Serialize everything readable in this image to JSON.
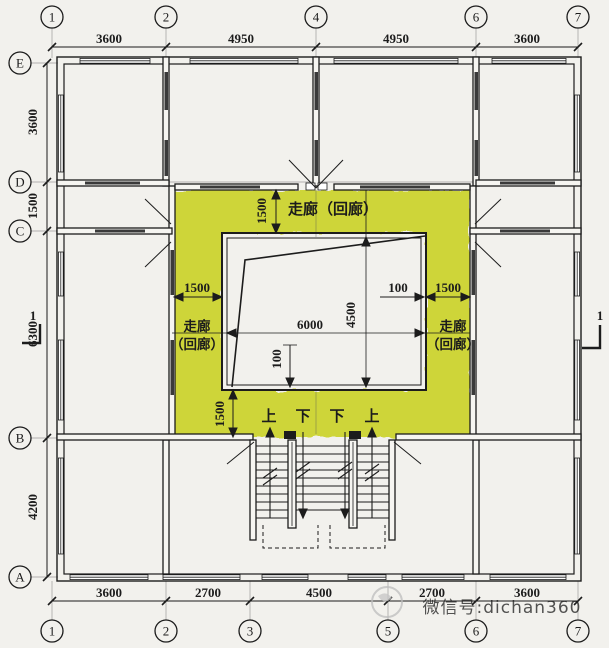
{
  "title": "floor-plan-corridor-diagram",
  "colors": {
    "corridor_highlight": "#ccd32b",
    "line": "#1c1c1c",
    "paper": "#f2f1ed",
    "watermark": "#b4b4b4"
  },
  "axes": {
    "top": {
      "bubbles": [
        "1",
        "2",
        "4",
        "6",
        "7"
      ],
      "dims": [
        "3600",
        "4950",
        "4950",
        "3600"
      ]
    },
    "left": {
      "bubbles": [
        "E",
        "D",
        "C",
        "B",
        "A"
      ],
      "dims": [
        "3600",
        "1500",
        "6300",
        "4200"
      ]
    },
    "bottom": {
      "bubbles": [
        "1",
        "2",
        "3",
        "5",
        "6",
        "7"
      ],
      "dims": [
        "3600",
        "2700",
        "4500",
        "2700",
        "3600"
      ]
    }
  },
  "corridor": {
    "top_label": "走廊（回廊）",
    "left_label_line1": "走廊",
    "left_label_line2": "（回廊）",
    "right_label_line1": "走廊",
    "right_label_line2": "（回廊）"
  },
  "inner_dims": {
    "top_offset": "1500",
    "left_corridor": "1500",
    "right_gap": "100",
    "right_corridor": "1500",
    "courtyard_width": "6000",
    "courtyard_height": "4500",
    "bottom_gap": "100",
    "bottom_offset": "1500"
  },
  "stairs": {
    "labels": [
      "上",
      "下",
      "下",
      "上"
    ]
  },
  "section_marks": {
    "left": "1",
    "right": "1"
  },
  "watermark": {
    "text": "微信号:dichan360"
  }
}
